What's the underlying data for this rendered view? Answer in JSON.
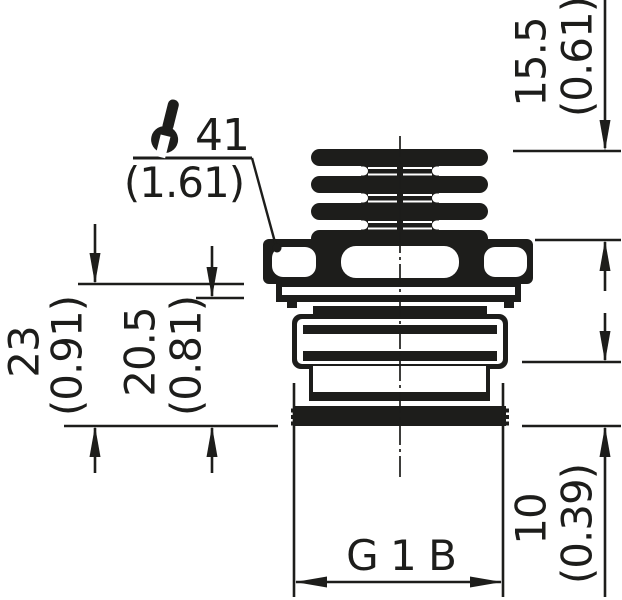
{
  "drawing": {
    "thread": {
      "label": "G 1 B"
    },
    "wrench": {
      "icon": "wrench-icon",
      "size_mm": "41",
      "size_inch": "(1.61)"
    },
    "dims": {
      "cap_to_nut": {
        "mm": "15.5",
        "inch": "(0.61)"
      },
      "nut_to_thread_end": {
        "mm": "23",
        "inch": "(0.91)"
      },
      "washer_to_thread_end": {
        "mm": "20.5",
        "inch": "(0.81)"
      },
      "thread_length": {
        "mm": "10",
        "inch": "(0.39)"
      }
    },
    "colors": {
      "ink": "#1d1d1b",
      "background": "#ffffff"
    }
  }
}
